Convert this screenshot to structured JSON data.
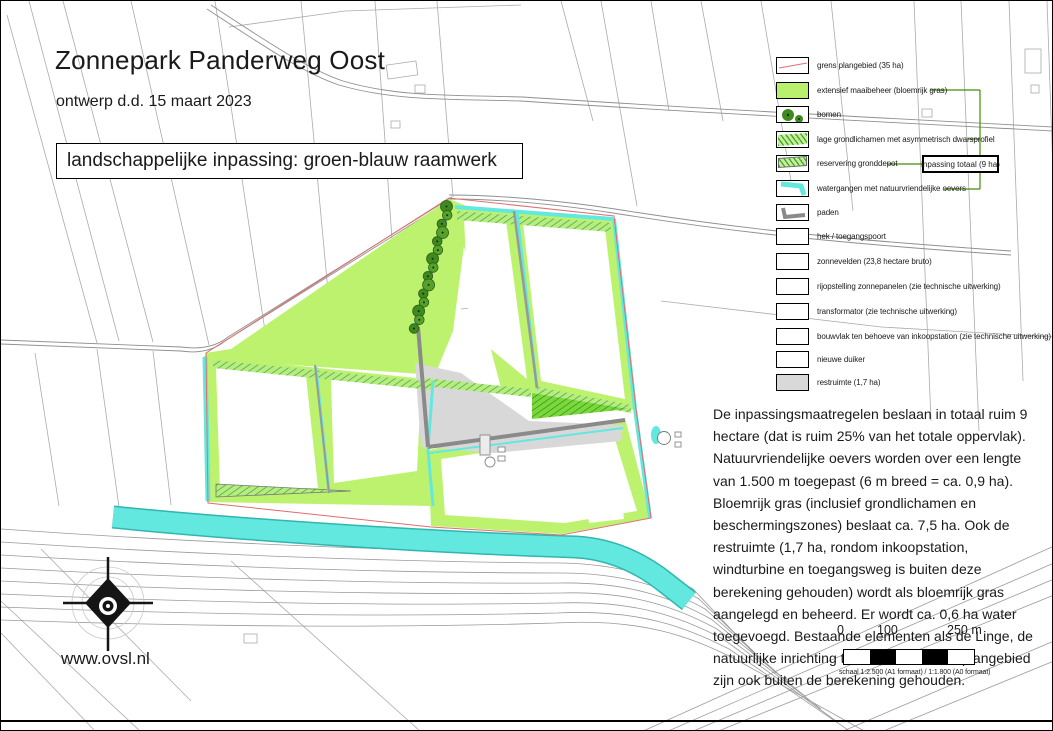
{
  "document": {
    "title": "Zonnepark Panderweg Oost",
    "subtitle": "ontwerp d.d. 15 maart 2023",
    "banner": "landschappelijke inpassing: groen-blauw raamwerk",
    "website": "www.ovsl.nl"
  },
  "legend": {
    "callout": "inpassing totaal (9 ha)",
    "items": [
      {
        "id": "grens-plangebied",
        "label": "grens plangebied (35 ha)",
        "swatch": "boundary"
      },
      {
        "id": "extensief-maaibeheer",
        "label": "extensief maaibeheer (bloemrijk gras)",
        "swatch": "green",
        "in_total": true
      },
      {
        "id": "bomen",
        "label": "bomen",
        "swatch": "trees"
      },
      {
        "id": "lage-grondlichamen",
        "label": "lage grondlichamen met asymmetrisch dwarsprofiel",
        "swatch": "hatch",
        "in_total": true
      },
      {
        "id": "reservering-gronddepot",
        "label": "reservering gronddepot",
        "swatch": "hatch-outline",
        "in_total": true
      },
      {
        "id": "watergangen",
        "label": "watergangen met natuurvriendelijke oevers",
        "swatch": "water",
        "in_total": true
      },
      {
        "id": "paden",
        "label": "paden",
        "swatch": "path"
      },
      {
        "id": "hek-toegangspoort",
        "label": "hek / toegangspoort",
        "swatch": "plain"
      },
      {
        "id": "zonnevelden",
        "label": "zonnevelden (23,8 hectare bruto)",
        "swatch": "plain"
      },
      {
        "id": "rijopstelling-zonnepanelen",
        "label": "rijopstelling zonnepanelen (zie technische uitwerking)",
        "swatch": "plain"
      },
      {
        "id": "transformator",
        "label": "transformator (zie technische uitwerking)",
        "swatch": "plain"
      },
      {
        "id": "bouwvlak-inkoopstation",
        "label": "bouwvlak ten behoeve van inkoopstation (zie technische uitwerking)",
        "swatch": "plain"
      },
      {
        "id": "nieuwe-duiker",
        "label": "nieuwe duiker",
        "swatch": "plain"
      },
      {
        "id": "restruimte",
        "label": "restruimte (1,7 ha)",
        "swatch": "gray"
      }
    ]
  },
  "description": {
    "text": "De inpassingsmaatregelen beslaan in totaal ruim 9 hectare (dat is ruim 25% van het totale oppervlak). Natuurvriendelijke oevers worden over een lengte van 1.500 m toegepast (6 m breed = ca. 0,9 ha). Bloemrijk gras (inclusief grondlichamen en beschermingszones) beslaat ca. 7,5 ha. Ook de restruimte (1,7 ha, rondom inkoopstation, windturbine en toegangsweg is buiten deze berekening gehouden) wordt als bloemrijk gras aangelegd en beheerd. Er wordt ca. 0,6 ha water toegevoegd. Bestaande elementen als de Linge, de natuurlijke inrichting ten westen van het plangebied zijn ook buiten de berekening gehouden."
  },
  "scalebar": {
    "ticks": [
      "0",
      "100",
      "250 m"
    ],
    "caption": "schaal 1:2.500 (A1 formaat) / 1:1.800 (A0 formaat)"
  },
  "colors": {
    "grass": "#bdf26e",
    "grass_dark": "#79d83c",
    "water": "#63e8e0",
    "water_edge": "#2fb6ae",
    "tree": "#3e8a1f",
    "hatch": "#4ba322",
    "restruimte": "#d8d8d8",
    "boundary_red": "#dd7070",
    "bracket_green": "#3f8f00",
    "path_gray": "#8a8a8a"
  }
}
